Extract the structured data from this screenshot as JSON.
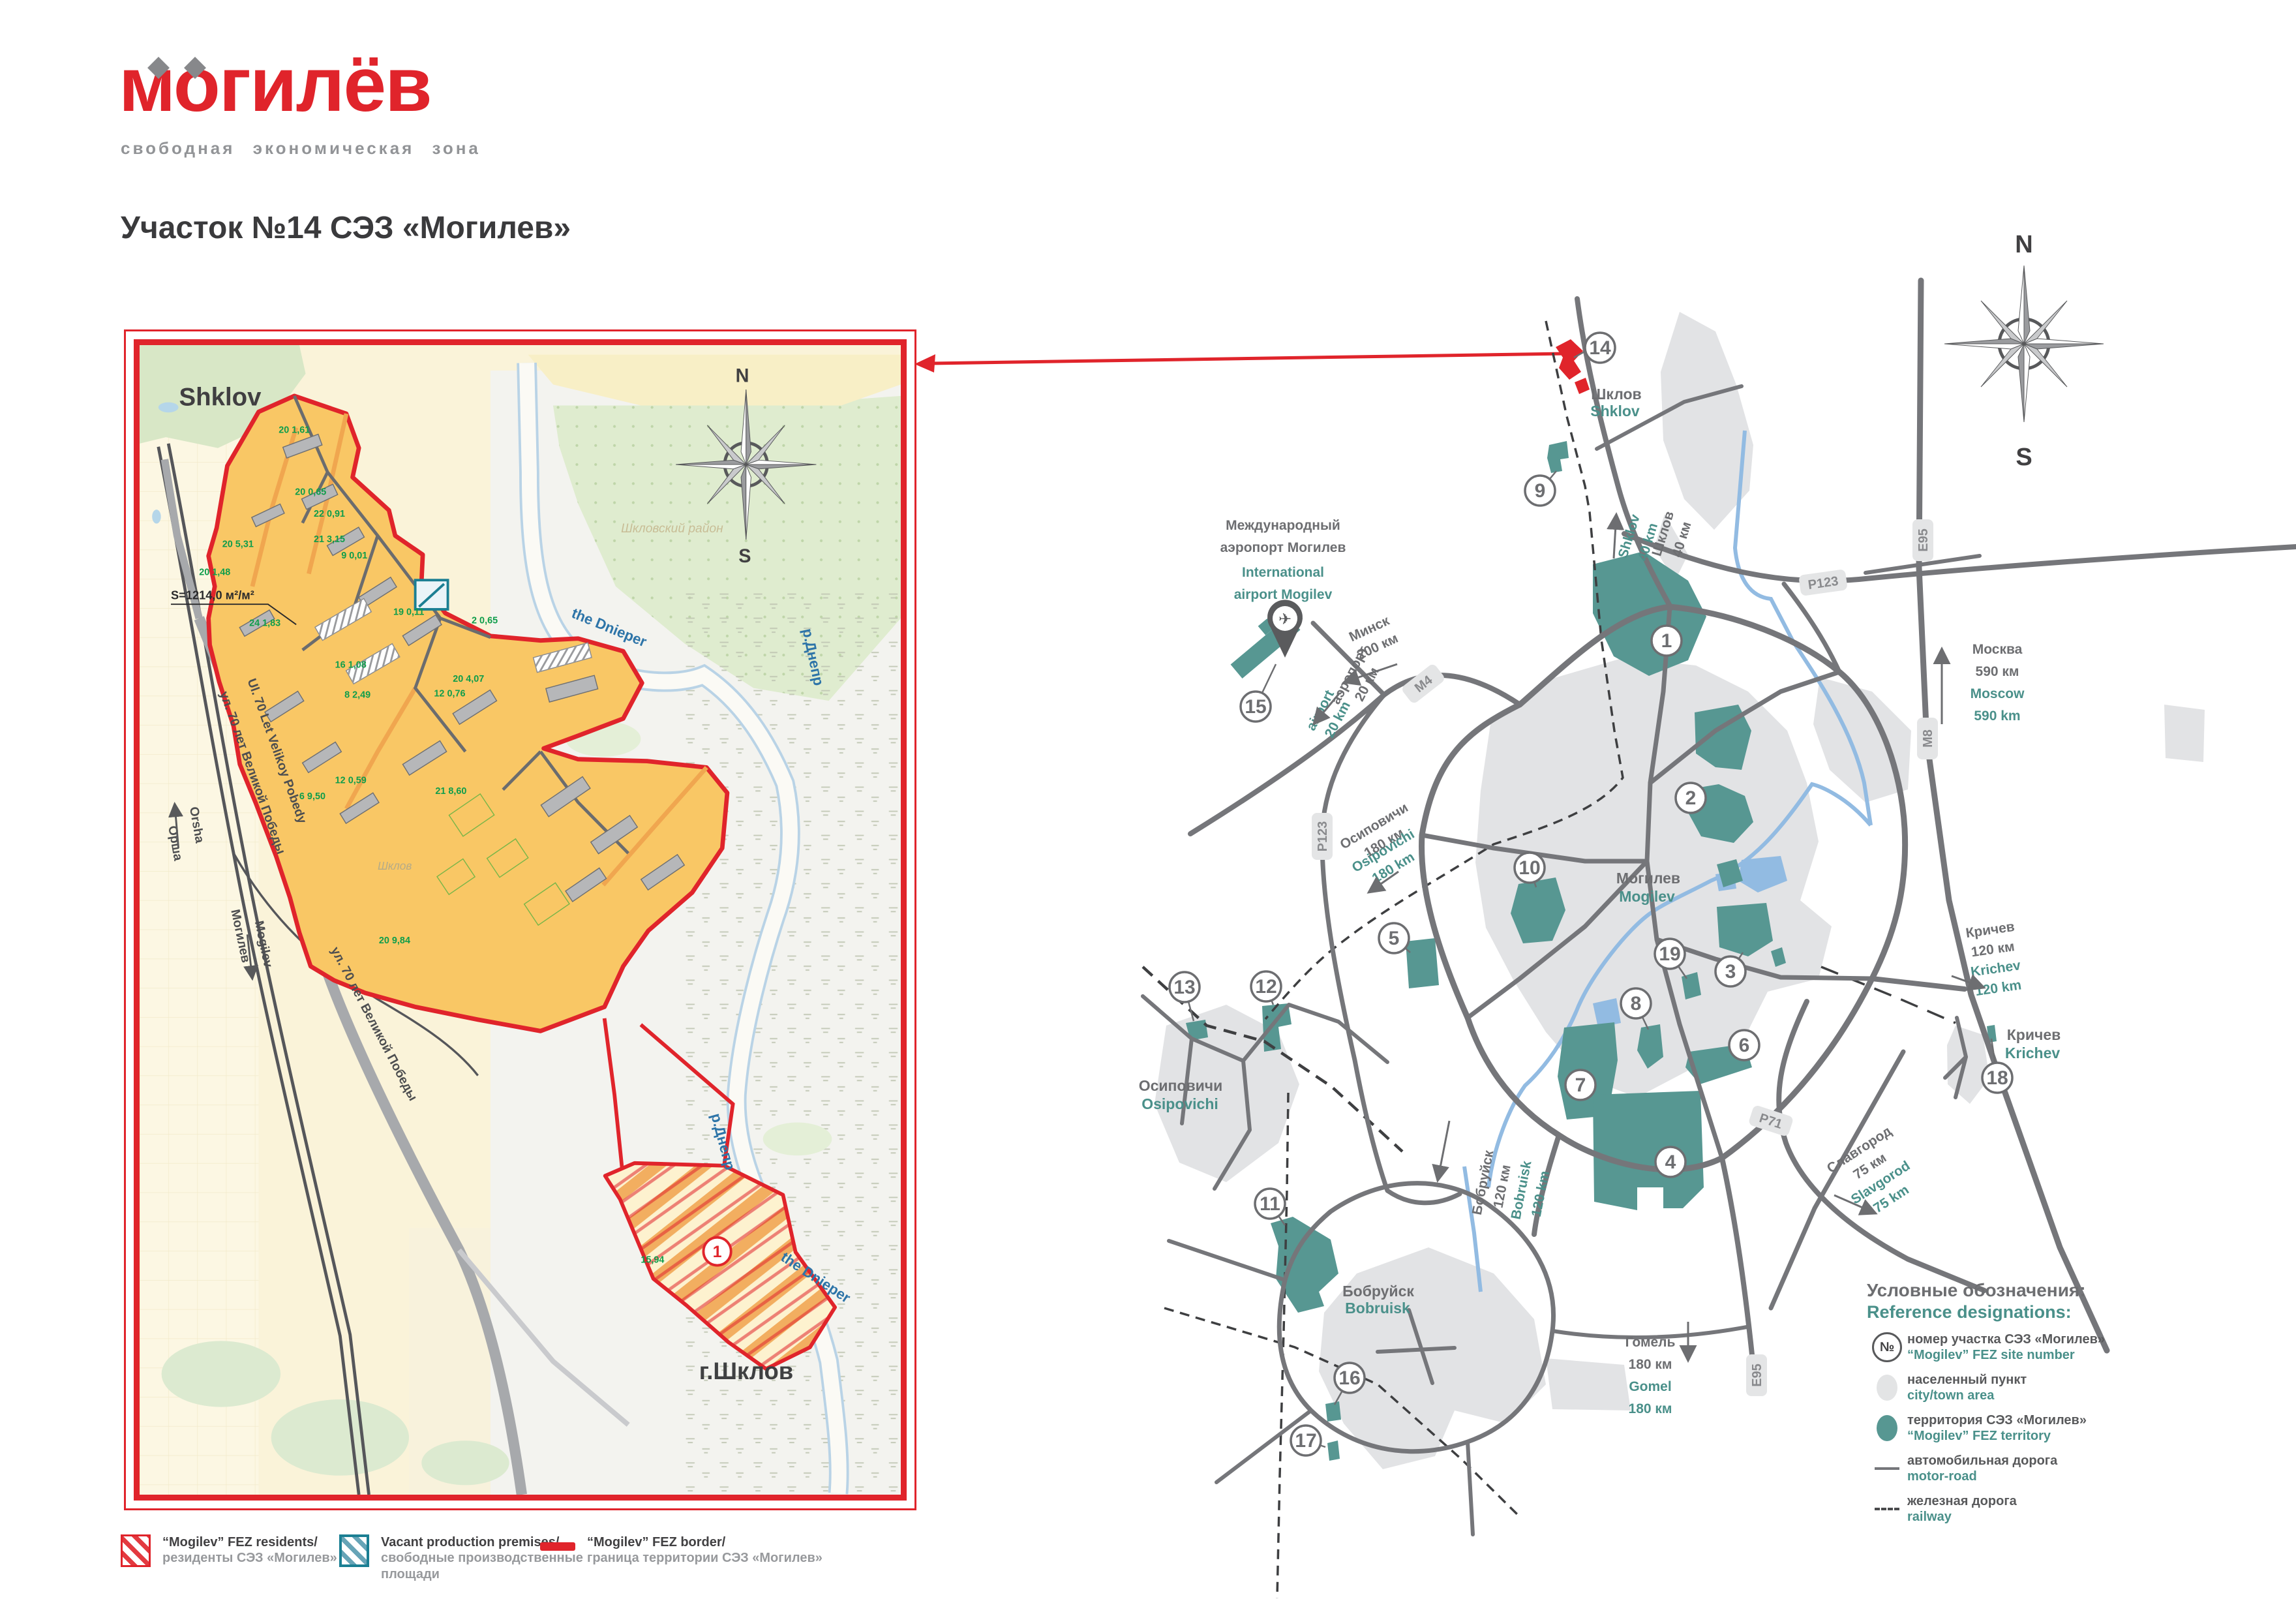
{
  "header": {
    "logo": "могилёв",
    "subtitle": "свободная экономическая зона",
    "title": "Участок №14 СЭЗ «Могилев»"
  },
  "detail_map": {
    "city_top": "Shklov",
    "area_note": "S=1214,0 м²/м²",
    "district": "Шкловский район",
    "town_inline": "Шклов",
    "river_en": "the Dnieper",
    "river_ru": "р.Днепр",
    "street_en": "Ul. 70 Let Velikoy Pobedy",
    "street_ru": "ул. 70 лет Великой Победы",
    "orsha_en": "Orsha",
    "orsha_ru": "Орша",
    "mogilev_ru": "Могилев",
    "mogilev_en": "Mogilev",
    "city_bottom": "г.Шклов",
    "site_number": "1",
    "compass_n": "N",
    "compass_s": "S",
    "parcels": [
      "20 1,61",
      "20 0,65",
      "22 0,91",
      "21 3,15",
      "9 0,01",
      "20 5,31",
      "20 1,48",
      "24 1,83",
      "19 0,11",
      "2 0,65",
      "8 2,49",
      "16 1,08",
      "12 0,76",
      "20 4,07",
      "21 8,60",
      "6 9,50",
      "12 0,59",
      "20 9,84",
      "15,94"
    ]
  },
  "schematic": {
    "compass_n": "N",
    "compass_s": "S",
    "sites": [
      "1",
      "2",
      "3",
      "4",
      "5",
      "6",
      "7",
      "8",
      "9",
      "10",
      "11",
      "12",
      "13",
      "14",
      "15",
      "16",
      "17",
      "18",
      "19"
    ],
    "towns": {
      "shklov_ru": "Шклов",
      "shklov_en": "Shklov",
      "mogilev_ru": "Могилев",
      "mogilev_en": "Mogilev",
      "osipovichi_ru": "Осиповичи",
      "osipovichi_en": "Osipovichi",
      "bobruisk_ru": "Бобруйск",
      "bobruisk_en": "Bobruisk",
      "krichev_ru": "Кричев",
      "krichev_en": "Krichev"
    },
    "airport": {
      "ru1": "Международный",
      "ru2": "аэропорт Могилев",
      "en1": "International",
      "en2": "airport Mogilev"
    },
    "directions": {
      "minsk_ru1": "Минск",
      "minsk_ru2": "200 км",
      "airport_ru1": "аэропорт",
      "airport_ru2": "20 км",
      "airport_en1": "airport",
      "airport_en2": "20 km",
      "shklov_ru1": "Шклов",
      "shklov_ru2": "40 км",
      "shklov_en1": "Shklov",
      "shklov_en2": "40 km",
      "osip_ru1": "Осиповичи",
      "osip_ru2": "180 км",
      "osip_en1": "Osipovichi",
      "osip_en2": "180 km",
      "moscow_ru1": "Москва",
      "moscow_ru2": "590 км",
      "moscow_en1": "Moscow",
      "moscow_en2": "590 km",
      "krichev_ru1": "Кричев",
      "krichev_ru2": "120 км",
      "krichev_en1": "Krichev",
      "krichev_en2": "120 km",
      "slavgorod_ru1": "Славгород",
      "slavgorod_ru2": "75 км",
      "slavgorod_en1": "Slavgorod",
      "slavgorod_en2": "75 km",
      "gomel_ru1": "Гомель",
      "gomel_ru2": "180 км",
      "gomel_en1": "Gomel",
      "gomel_en2": "180 км",
      "bobruisk_ru1": "Бобруйск",
      "bobruisk_ru2": "120 км",
      "bobruisk_en1": "Bobruisk",
      "bobruisk_en2": "120 km"
    },
    "badges": {
      "m4": "М4",
      "p123": "Р123",
      "e95": "Е95",
      "m8": "М8",
      "p71": "Р71"
    }
  },
  "legend_reference": {
    "title_ru": "Условные обозначения:",
    "title_en": "Reference designations:",
    "num_symbol": "№",
    "items": [
      {
        "ru": "номер участка СЭЗ «Могилев»",
        "en": "“Mogilev” FEZ site number"
      },
      {
        "ru": "населенный пункт",
        "en": "city/town area"
      },
      {
        "ru": "территория СЭЗ «Могилев»",
        "en": "“Mogilev” FEZ territory"
      },
      {
        "ru": "автомобильная дорога",
        "en": "motor-road"
      },
      {
        "ru": "железная дорога",
        "en": "railway"
      }
    ]
  },
  "legend_bottom": {
    "residents_en": "“Mogilev” FEZ residents/",
    "residents_ru": "резиденты СЭЗ «Могилев»",
    "vacant_en": "Vacant production premises/",
    "vacant_ru1": "свободные производственные",
    "vacant_ru2": "площади",
    "border_en": "“Mogilev” FEZ border/",
    "border_ru": "граница территории СЭЗ «Могилев»"
  }
}
